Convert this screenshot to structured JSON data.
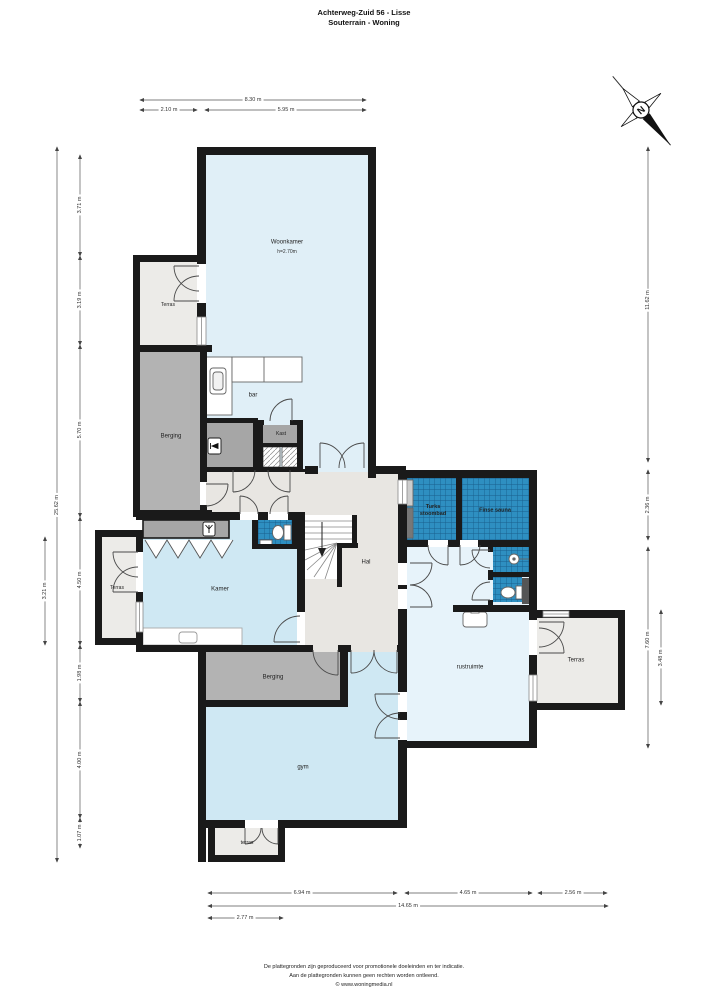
{
  "title": {
    "line1": "Achterweg-Zuid 56 - Lisse",
    "line2": "Souterrain - Woning"
  },
  "compass": {
    "north_label": "N"
  },
  "rooms": {
    "woonkamer": {
      "name": "Woonkamer",
      "height_note": "h=2.70m"
    },
    "terras_boven": {
      "name": "Terras"
    },
    "berging_midden": {
      "name": "Berging"
    },
    "bar": {
      "name": "bar"
    },
    "kast": {
      "name": "Kast"
    },
    "hal": {
      "name": "Hal"
    },
    "kamer": {
      "name": "Kamer"
    },
    "terras_kamer": {
      "name": "Terras"
    },
    "turks_stoombad": {
      "name": "Turks stoombad"
    },
    "finse_sauna": {
      "name": "Finse sauna"
    },
    "rustruimte": {
      "name": "rustruimte"
    },
    "terras_rechts": {
      "name": "Terras"
    },
    "berging_onder": {
      "name": "Berging"
    },
    "gym": {
      "name": "gym"
    },
    "terras_onder": {
      "name": "terras"
    }
  },
  "dimensions": {
    "top": {
      "total": "8.30 m",
      "left": "2.10 m",
      "right": "5.95 m"
    },
    "left": {
      "total": "25.62 m",
      "segments": [
        "3.71 m",
        "3.19 m",
        "5.70 m",
        "4.50 m",
        "1.98 m",
        "4.00 m",
        "1.07 m"
      ],
      "kamer": "3.21 m"
    },
    "right": {
      "upper": "11.62 m",
      "middle": "2.36 m",
      "lower": "7.60 m",
      "inner": "3.48 m"
    },
    "bottom": {
      "left": "6.94 m",
      "middle": "4.65 m",
      "right": "2.56 m",
      "total": "14.65 m",
      "terras": "2.77 m"
    }
  },
  "footer": {
    "line1": "De plattegronden zijn geproduceerd voor promotionele doeleinden en ter indicatie.",
    "line2": "Aan de plattegronden kunnen geen rechten worden ontleend.",
    "line3": "© www.woningmedia.nl"
  },
  "colors": {
    "room_blue": "#cfe8f3",
    "room_blue_light": "#e0eff7",
    "room_blue_pale": "#e7f3fa",
    "tile_blue": "#2e8fc1",
    "tile_grid": "#195f8d",
    "gray_storage": "#b3b3b3",
    "gray_dark": "#a6a6a6",
    "terras_gray": "#ecebe8",
    "hal_gray": "#e8e6e2",
    "wall": "#1a1a1a"
  }
}
